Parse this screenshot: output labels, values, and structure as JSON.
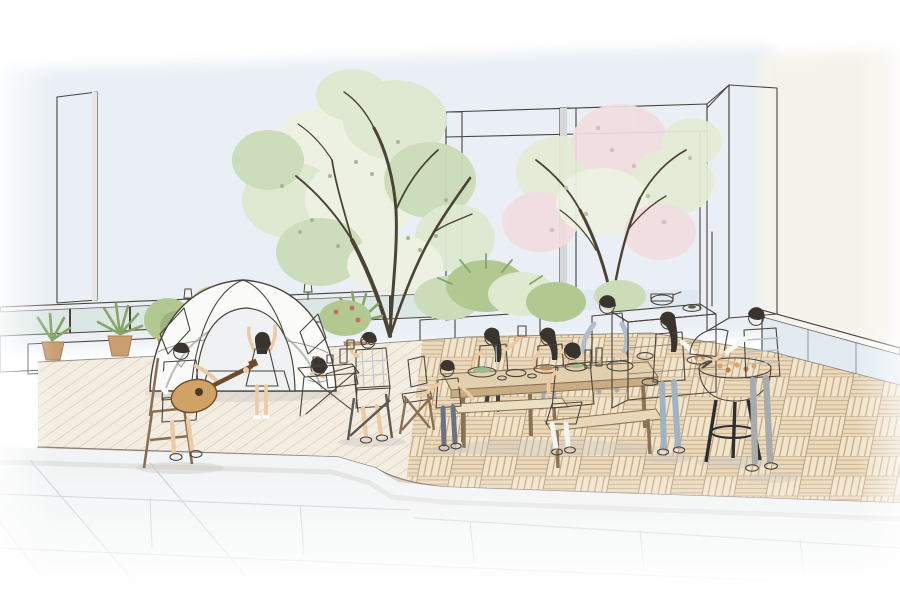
{
  "scene": {
    "description": "Hand-drawn watercolor architectural illustration of a rooftop terrace: a family camps with a dome tent and guitar on a wooden deck at left, a family dines at a long wooden table in the center, and a couple barbecues at a kettle grill on the right, surrounded by planters, trees and glass railings.",
    "style": "ink line-work with light watercolor washes",
    "objects": [
      {
        "name": "dome-tent",
        "label": "white dome tent with open door and mat"
      },
      {
        "name": "guitar-man",
        "label": "man on folding chair playing acoustic guitar"
      },
      {
        "name": "dancing-girl",
        "label": "girl in pink dress dancing with raised arms"
      },
      {
        "name": "lying-girl",
        "label": "girl lying inside tent, chin on hands"
      },
      {
        "name": "camp-table-man",
        "label": "man with glasses at folding camp table"
      },
      {
        "name": "dining-group",
        "label": "five people at long wooden dining table with food"
      },
      {
        "name": "bbq-pair",
        "label": "woman with tray and man grilling at kettle barbecue"
      },
      {
        "name": "outdoor-kitchen",
        "label": "white outdoor kitchen counter with pots"
      },
      {
        "name": "center-tree",
        "label": "large green tree"
      },
      {
        "name": "blossom-tree",
        "label": "pink flowering tree"
      },
      {
        "name": "planters",
        "label": "potted palms and shrubs along parapet"
      },
      {
        "name": "deck",
        "label": "raised wood deck: diagonal planks and parquet tiles"
      },
      {
        "name": "pavers",
        "label": "light stone paving in foreground"
      },
      {
        "name": "glass-railing",
        "label": "glass balustrades on parapet and right side"
      },
      {
        "name": "pergola",
        "label": "white pergola frame and corner column"
      }
    ]
  },
  "colors": {
    "sky": "#e9eff5",
    "skyWarm": "#f4f3ea",
    "line": "#4a443c",
    "lineSoft": "#6f6f66",
    "branch": "#4d4334",
    "foliagePale": "#edf2e2",
    "foliageLight": "#dfe9d0",
    "foliageMid": "#ccdcb8",
    "foliageDot": "#a4b98c",
    "blossomPink": "#f1dde0",
    "blossomGreen": "#e4ecd6",
    "blossomDotPink": "#dbb9c0",
    "blossomDotGreen": "#b7c8a2",
    "bushMid": "#b3c791",
    "bushDark": "#96ad78",
    "palm": "#86a567",
    "pot": "#c99f72",
    "potDark": "#a97f55",
    "glassTeal": "#d8e5e1",
    "glassBlue": "#dde7ee",
    "railWhite": "#fbfcfc",
    "wallWhite": "#fdfdfc",
    "wallShade": "#e7e8e6",
    "wallShade2": "#d6d8d8",
    "tentWhite": "#fbfbf9",
    "tentPanel": "#e2e6e8",
    "tentOpen": "#eff1f2",
    "mat": "#ced3d5",
    "deckLeft": "#f3ede1",
    "plankLine": "#d3bd9d",
    "deckRight": "#ead9bd",
    "deckRightAlt": "#f1e4cc",
    "deckStripe": "#c3a87f",
    "deckCellLine": "#b2976e",
    "curb": "#dacfbc",
    "curbLine": "#8a8177",
    "paver": "#f1f3f4",
    "paverLine": "#c6cacd",
    "shadow": "#c9c6c0",
    "skin": "#eccaa4",
    "hair": "#3a342e",
    "white": "#f7f7f5",
    "polo": "#fafaf9",
    "jeans": "#9fb3c6",
    "denimShort": "#5d7389",
    "pink": "#eeb2bc",
    "shirtBlue": "#aebfca",
    "plaid": "#e7eaec",
    "khaki": "#d8cdb0",
    "vest": "#efe6c8",
    "grayTee": "#e2e5e6",
    "boyPants": "#6a7480",
    "grayPants": "#a8abad",
    "guitar": "#d0a266",
    "guitarDark": "#6e4b2c",
    "grill": "#2e2e30",
    "grillFood1": "#d8a85c",
    "grillFood2": "#b97e4e",
    "counter": "#f6f6f3",
    "counterShade": "#e9e9e4",
    "wood": "#e2cfae",
    "woodEdge": "#c8ac83",
    "woodDark": "#8a7354",
    "bottle": "#564f44",
    "potBlack": "#3b3b3d",
    "foodGreen": "#9fb88a",
    "foodBrown": "#b98d5e"
  }
}
